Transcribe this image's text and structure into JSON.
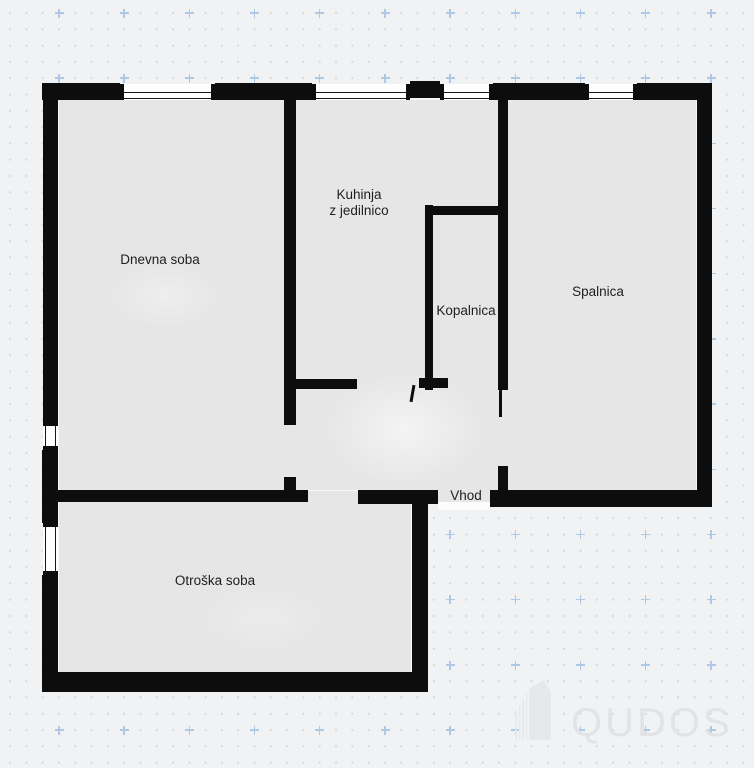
{
  "rooms": {
    "living": {
      "label": "Dnevna soba"
    },
    "kitchen": {
      "label_line1": "Kuhinja",
      "label_line2": "z jedilnico"
    },
    "bath": {
      "label": "Kopalnica"
    },
    "bedroom": {
      "label": "Spalnica"
    },
    "entrance": {
      "label": "Vhod"
    },
    "kids": {
      "label": "Otroška soba"
    }
  },
  "watermark": {
    "brand": "QUDOS",
    "icon": "building-icon"
  },
  "colors": {
    "background": "#f1f2f4",
    "grid_dot": "#d6d8db",
    "grid_plus": "#aec9e7",
    "wall": "#0d0d0d",
    "room_fill": "#e6e6e6",
    "label_text": "#1e1e1e",
    "watermark": "#e1e3e7"
  }
}
